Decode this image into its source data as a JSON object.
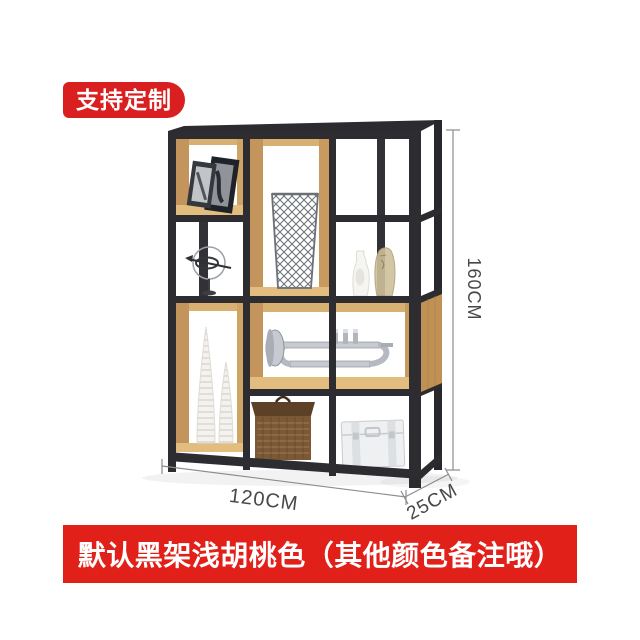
{
  "badge": {
    "label": "支持定制",
    "background": "#d91f1f",
    "text_color": "#ffffff"
  },
  "banner": {
    "label": "默认黑架浅胡桃色（其他颜色备注哦）",
    "background": "#e1201a",
    "text_color": "#ffffff"
  },
  "dimensions": {
    "height": "160CM",
    "width": "120CM",
    "depth": "25CM"
  },
  "product": {
    "type": "metal-frame-wood-display-shelf",
    "frame_color": "#2c2c31",
    "wood_color": "#d8b172",
    "wood_side_color": "#c3945b",
    "background_color": "#ffffff",
    "dimension_line_color": "#8c8c8c",
    "props": [
      "picture-frames",
      "wire-basket",
      "ring-sculpture",
      "white-vase",
      "glass-head-sculpture",
      "spiral-vases",
      "trumpet",
      "wicker-basket",
      "white-trunk"
    ]
  }
}
